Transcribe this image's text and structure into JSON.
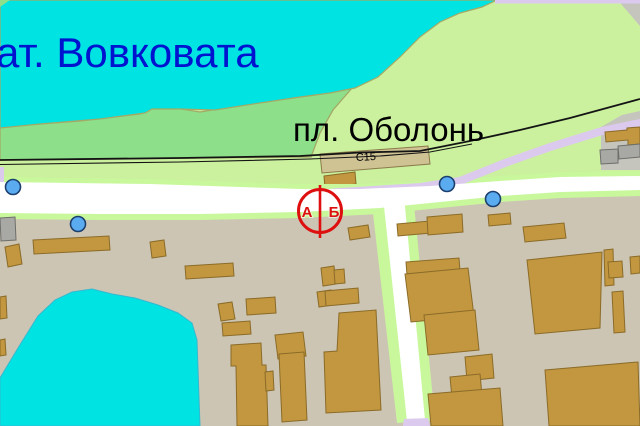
{
  "map": {
    "labels": {
      "water_name": "ат. Вовковата",
      "platform_name": "пл. Оболонь",
      "platform_code": "С15",
      "marker_letter_left": "А",
      "marker_letter_right": "Б"
    },
    "marker": {
      "type": "split-circle-marker",
      "sides": [
        "А",
        "Б"
      ]
    },
    "poi_dots": 4,
    "colors": {
      "water": "#00e3e3",
      "shore_green": "#8ddf8a",
      "field_green": "#cbf09e",
      "land": "#cdc5b3",
      "road_white": "#ffffff",
      "road_edge": "#c9f89c",
      "road_lavender": "#dccaee",
      "building": "#c2973f",
      "building_border": "#8a6b28",
      "gray_area": "#c5c5be",
      "railway": "#141414",
      "marker_red": "#dd0f0f",
      "label_blue": "#0013cf",
      "poi_dot_blue": "#5aabf0"
    }
  }
}
